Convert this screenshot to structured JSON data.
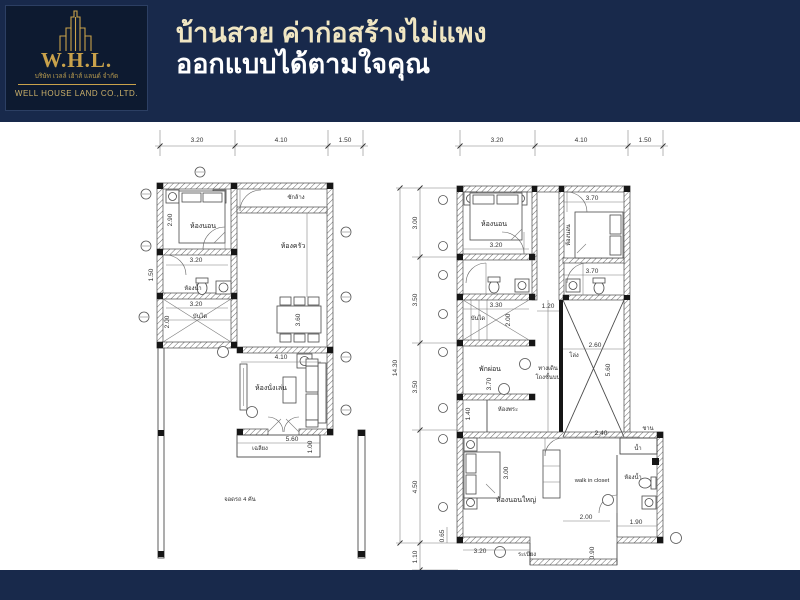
{
  "brand": {
    "initials": "W.H.L.",
    "thai_name": "บริษัท เวลล์ เฮ้าส์ แลนด์ จำกัด",
    "company": "WELL HOUSE LAND CO.,LTD."
  },
  "header": {
    "line1": "บ้านสวย ค่าก่อสร้างไม่แพง",
    "line2": "ออกแบบได้ตามใจคุณ"
  },
  "colors": {
    "navy": "#18294b",
    "logo_navy": "#0d1a30",
    "gold": "#c9a24b",
    "cream": "#f0e6c3",
    "plan_line": "#4a4a4a"
  },
  "plan_left": {
    "top_dims": [
      "3.20",
      "4.10",
      "1.50"
    ],
    "rooms": {
      "bedroom": "ห้องนอน",
      "laundry": "ซักล้าง",
      "kitchen": "ห้องครัว",
      "bath": "ห้องน้ำ",
      "stairs": "บันได",
      "living": "ห้องนั่งเล่น",
      "porch": "เฉลียง",
      "carport": "จอดรถ 4 คัน"
    },
    "dims": {
      "bedroom_h": "2.90",
      "bath_w": "3.20",
      "bath_h": "1.50",
      "stairs_w": "3.20",
      "stairs_h": "2.00",
      "dining_h": "3.60",
      "living_w": "4.10",
      "porch_w": "5.60",
      "porch_h": "1.00"
    }
  },
  "plan_right": {
    "top_dims": [
      "3.20",
      "4.10",
      "1.50"
    ],
    "overall_h": "14.30",
    "side_dims": [
      "3.00",
      "3.50",
      "3.50",
      "4.50",
      "1.10"
    ],
    "offset_dim": "0.65",
    "rooms": {
      "bedroom_left": "ห้องนอน",
      "bedroom_right": "ห้องนอน",
      "stairs": "บันได",
      "hallway1": "ทางเดิน",
      "hallway2": "โถงชั้นบน",
      "void": "โล่ง",
      "relax": "พักผ่อน",
      "prayer": "ห้องพระ",
      "master": "ห้องนอนใหญ่",
      "closet": "walk in closet",
      "bath": "ห้องน้ำ",
      "balcony": "ระเบียง",
      "terrace": "ชาน",
      "water": "น้ำ"
    },
    "dims": {
      "bed_l_w": "3.20",
      "bed_r_w": "3.70",
      "bath_r_w": "3.70",
      "stairs_w": "3.30",
      "stairs_h": "2.00",
      "hall_w": "1.20",
      "void_w": "2.60",
      "void_h": "5.60",
      "relax_h": "3.70",
      "prayer_h": "1.40",
      "master_h": "3.00",
      "master_w": "3.20",
      "closet_w": "2.40",
      "closet_d": "2.00",
      "bath_w": "1.90",
      "balcony_d": "0.90"
    }
  }
}
